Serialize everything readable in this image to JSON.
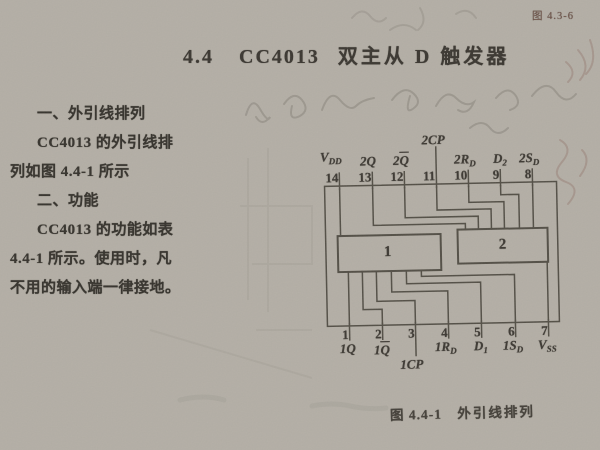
{
  "page": {
    "corner_label": "图 4.3-6",
    "header": {
      "section_no": "4.4",
      "chip": "CC4013",
      "title_rest": "双主从 D 触发器"
    },
    "caption": {
      "fig": "图 4.4-1",
      "text": "外引线排列"
    }
  },
  "paragraph": {
    "lines": [
      "一、外引线排列",
      "CC4013 的外引线排",
      "列如图 4.4-1 所示",
      "二、功能",
      "CC4013 的功能如表",
      "4.4-1 所示。使用时，凡",
      "不用的输入端一律接地。"
    ]
  },
  "diagram": {
    "block1_label": "1",
    "block2_label": "2",
    "top_pins": [
      {
        "number": "14",
        "label": {
          "text": "V",
          "sub": "DD"
        }
      },
      {
        "number": "13",
        "label": {
          "text": "2Q"
        }
      },
      {
        "number": "12",
        "label": {
          "pre": "2",
          "ov": "Q"
        }
      },
      {
        "number": "11",
        "label": {
          "text": "2CP"
        }
      },
      {
        "number": "10",
        "label": {
          "text": "2R",
          "sub": "D"
        }
      },
      {
        "number": "9",
        "label": {
          "text": "D",
          "sub": "2"
        }
      },
      {
        "number": "8",
        "label": {
          "text": "2S",
          "sub": "D"
        }
      }
    ],
    "bottom_pins": [
      {
        "number": "1",
        "label": {
          "text": "1Q"
        }
      },
      {
        "number": "2",
        "label": {
          "pre": "1",
          "ov": "Q"
        }
      },
      {
        "number": "3",
        "label": {
          "text": "1CP"
        }
      },
      {
        "number": "4",
        "label": {
          "text": "1R",
          "sub": "D"
        }
      },
      {
        "number": "5",
        "label": {
          "text": "D",
          "sub": "1"
        }
      },
      {
        "number": "6",
        "label": {
          "text": "1S",
          "sub": "D"
        }
      },
      {
        "number": "7",
        "label": {
          "text": "V",
          "sub": "SS"
        }
      }
    ]
  }
}
